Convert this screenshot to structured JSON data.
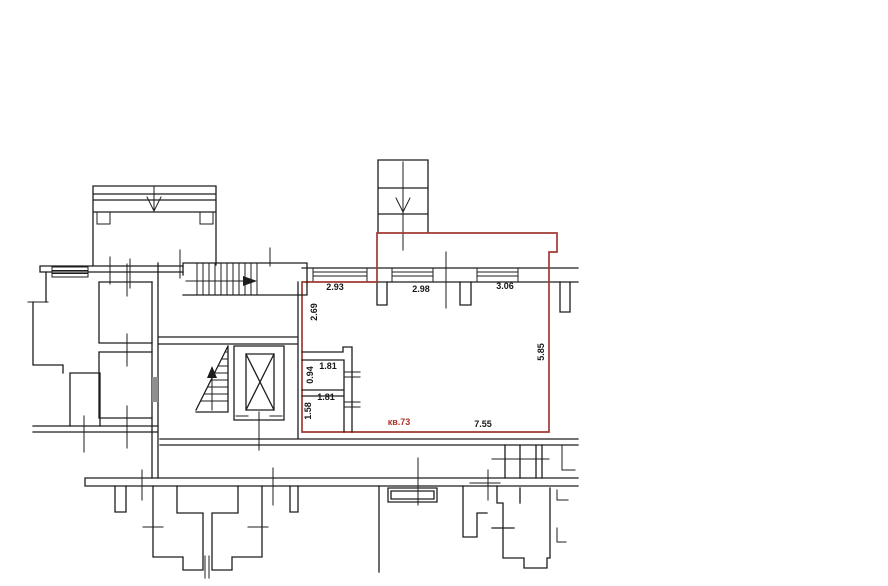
{
  "colors": {
    "background": "#ffffff",
    "walls": "#1d1d1d",
    "apartment_outline": "#a03a34",
    "apartment_label": "#ad332c",
    "door_leaf": "#8f8f8f"
  },
  "apartment": {
    "number_label": "кв.73",
    "dimensions": {
      "window_left": "2.93",
      "window_middle": "2.98",
      "window_right": "3.06",
      "wall_left": "2.69",
      "wall_right": "5.85",
      "wall_bottom": "7.55",
      "wc_width": "1.81",
      "wc_depth": "0.94",
      "bath_width": "1.81",
      "bath_depth": "1.58"
    }
  },
  "plan": {
    "arrows": {
      "balcony_chute": "down",
      "garbage_chute": "down",
      "stair_upper_flight": "right",
      "stair_lower_flight": "up"
    }
  }
}
